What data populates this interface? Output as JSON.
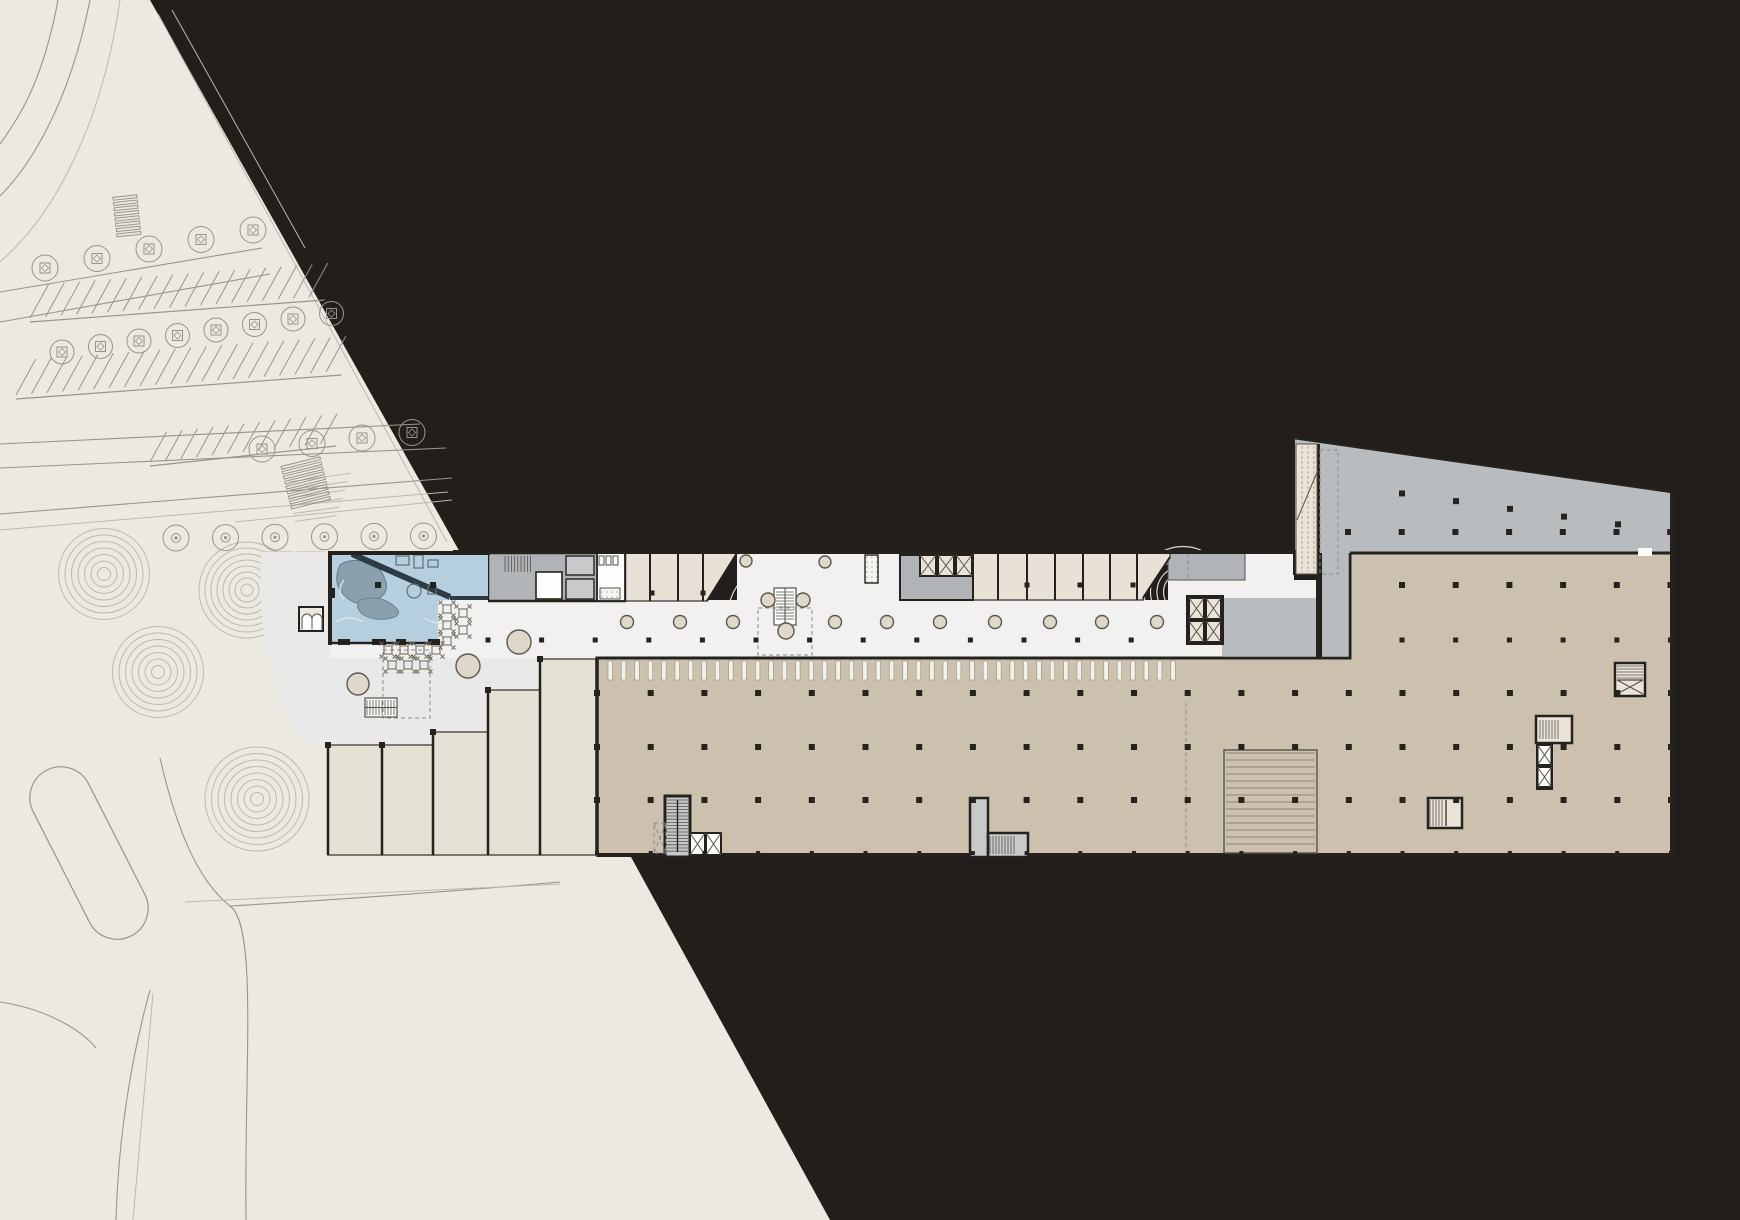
{
  "meta": {
    "drawing_kind": "architectural-site-and-floor-plan",
    "description": "Ground floor plan of an elongated mixed-use building with pool pavilion, mall concourse, retail units, parking floor, cores and landscaped site with roads and parking"
  },
  "palette": {
    "bg": "#211e1b",
    "site": "#ece9e1",
    "siteLine": "#99948b",
    "siteLineSoft": "#bcb8ae",
    "plaza": "#e9e9e8",
    "mall": "#f2f1ef",
    "ringPlaza": "#dbd9d4",
    "ringSite": "#beb9af",
    "tan": "#cbc1ae",
    "retail": "#e8e2d6",
    "terrace": "#e5e0d4",
    "grayZone": "#b9bcbe",
    "grayRoom": "#b1b4b7",
    "coreGray": "#c7c9cb",
    "wall": "#25221e",
    "wallSoft": "#56524b",
    "col": "#26231f",
    "pool": "#b6cfdf",
    "poolRock": "#8aa0ad",
    "poolRockDark": "#6e8493",
    "poolWall": "#2c3b44",
    "planter": "#ded7ca",
    "planterLine": "#5c5850",
    "white": "#fdfdfc",
    "cellCream": "#eae4d8"
  },
  "drawing": {
    "column_grids": [
      {
        "name": "mall-columns",
        "y": 640,
        "x0": 488,
        "dx": 53.6,
        "n": 13,
        "s": 5
      },
      {
        "name": "tan-row-1",
        "y": 693,
        "x0": 597,
        "dx": 53.7,
        "n": 21,
        "s": 6
      },
      {
        "name": "tan-row-2",
        "y": 747,
        "x0": 597,
        "dx": 53.7,
        "n": 21,
        "s": 6
      },
      {
        "name": "tan-row-3",
        "y": 800,
        "x0": 597,
        "dx": 53.7,
        "n": 21,
        "s": 6
      },
      {
        "name": "tan-row-4",
        "y": 853,
        "x0": 597,
        "dx": 53.7,
        "n": 21,
        "s": 4
      },
      {
        "name": "right-row-1",
        "y": 585,
        "x0": 1402,
        "dx": 53.7,
        "n": 6,
        "s": 6
      },
      {
        "name": "right-row-2",
        "y": 640,
        "x0": 1402,
        "dx": 53.7,
        "n": 6,
        "s": 5
      },
      {
        "name": "wing-row-2",
        "y": 532,
        "x0": 1348,
        "dx": 53.7,
        "n": 7,
        "s": 6
      },
      {
        "name": "retailA-cols",
        "y": 593,
        "x0": 652,
        "dx": 51,
        "n": 2,
        "s": 5
      },
      {
        "name": "retailB-cols",
        "y": 585,
        "x0": 1027,
        "dx": 53,
        "n": 3,
        "s": 5
      }
    ],
    "wing_slope_columns": {
      "x0": 1402,
      "dx": 54,
      "n": 5,
      "edge_y0": 438,
      "edge_x0": 1294,
      "slope": 0.143,
      "offset": 40,
      "s": 6
    },
    "corridor_circles": {
      "y": 622,
      "r": 6.5,
      "xs": [
        627,
        680,
        733,
        835,
        887,
        940,
        995,
        1050,
        1102,
        1157
      ]
    },
    "extra_circles": [
      [
        768,
        600,
        7
      ],
      [
        803,
        600,
        7
      ],
      [
        786,
        631,
        8
      ],
      [
        746,
        561,
        6
      ],
      [
        825,
        562,
        6
      ],
      [
        358,
        684,
        11
      ],
      [
        519,
        642,
        12
      ],
      [
        468,
        666,
        12
      ]
    ],
    "tick_band": {
      "x0": 608,
      "x1": 1172,
      "dx": 13.4,
      "y": 661,
      "h": 19,
      "w": 4.5
    },
    "ramp_lines": {
      "x": 1226,
      "w": 89,
      "y0": 753,
      "y1": 850,
      "dy": 7
    },
    "ring_sets": [
      {
        "cx": 104,
        "cy": 574,
        "n": 7,
        "dr": 6.5,
        "cls": "ring-site"
      },
      {
        "cx": 247,
        "cy": 590,
        "n": 8,
        "dr": 6,
        "cls": "ring-site"
      },
      {
        "cx": 158,
        "cy": 672,
        "n": 7,
        "dr": 6.5,
        "cls": "ring-site"
      },
      {
        "cx": 257,
        "cy": 799,
        "n": 8,
        "dr": 6.5,
        "cls": "ring-site"
      },
      {
        "cx": 375,
        "cy": 712,
        "n": 8,
        "dr": 6.5,
        "cls": "ring-plaza"
      },
      {
        "cx": 308,
        "cy": 648,
        "n": 6,
        "dr": 6.5,
        "cls": "ring-plaza"
      },
      {
        "cx": 612,
        "cy": 612,
        "n": 7,
        "dr": 6.5,
        "cls": "ring-plaza"
      },
      {
        "cx": 786,
        "cy": 618,
        "n": 9,
        "dr": 6.5,
        "cls": "ring-plaza"
      },
      {
        "cx": 945,
        "cy": 607,
        "n": 8,
        "dr": 7,
        "cls": "ring-plaza"
      },
      {
        "cx": 1183,
        "cy": 592,
        "n": 7,
        "dr": 6.5,
        "cls": "ring-plaza"
      },
      {
        "cx": 472,
        "cy": 628,
        "n": 4,
        "dr": 6,
        "cls": "ring-plaza"
      }
    ],
    "parking_rows": [
      {
        "x0": 30,
        "y0": 318,
        "dx": 15.5,
        "n": 19,
        "len": 34,
        "rise": 22
      },
      {
        "x0": 16,
        "y0": 395,
        "dx": 15.5,
        "n": 21,
        "len": 36,
        "rise": 24
      },
      {
        "x0": 150,
        "y0": 462,
        "dx": 15.5,
        "n": 12,
        "len": 30,
        "rise": 20
      }
    ],
    "tree_rows": [
      {
        "x0": 45,
        "y0": 268,
        "dx": 52,
        "dy": -9.5,
        "n": 5,
        "r": 13,
        "planter": true
      },
      {
        "x0": 62,
        "y0": 352,
        "dx": 38.5,
        "dy": -5.5,
        "n": 8,
        "r": 12,
        "planter": true
      },
      {
        "x0": 262,
        "y0": 449,
        "dx": 50,
        "dy": -5.5,
        "n": 4,
        "r": 13,
        "planter": true
      },
      {
        "x0": 176,
        "y0": 538,
        "dx": 49.5,
        "dy": -0.4,
        "n": 6,
        "r": 13,
        "planter": false
      }
    ],
    "crosswalks": [
      {
        "cx": 306,
        "cy": 484,
        "w": 40,
        "h": 46,
        "bars": 9,
        "rot": -14
      },
      {
        "cx": 127,
        "cy": 217,
        "w": 24,
        "h": 42,
        "bars": 8,
        "rot": -6
      }
    ],
    "tables": {
      "size": 8,
      "positions": [
        [
          447,
          609
        ],
        [
          447,
          625
        ],
        [
          447,
          641
        ],
        [
          463,
          613
        ],
        [
          463,
          630
        ],
        [
          388,
          650
        ],
        [
          404,
          650
        ],
        [
          420,
          650
        ],
        [
          436,
          650
        ],
        [
          392,
          665
        ],
        [
          408,
          665
        ],
        [
          424,
          665
        ]
      ]
    },
    "terraces": {
      "bottom": 855,
      "units": [
        {
          "x": 328,
          "w": 54,
          "top": 745
        },
        {
          "x": 382,
          "w": 51,
          "top": 745
        },
        {
          "x": 433,
          "w": 55,
          "top": 732
        },
        {
          "x": 488,
          "w": 52,
          "top": 690
        },
        {
          "x": 540,
          "w": 57,
          "top": 659
        }
      ]
    },
    "retail_a": {
      "x0": 625,
      "x1": 737,
      "y0": 553,
      "y1": 601,
      "dividers": [
        650,
        678,
        703
      ],
      "diag": [
        737,
        553,
        707,
        601
      ]
    },
    "retail_b": {
      "x0": 973,
      "x1": 1170,
      "y0": 553,
      "y1": 600,
      "dividers": [
        998,
        1027,
        1055,
        1083,
        1110,
        1137
      ],
      "diag": [
        1170,
        557,
        1143,
        598
      ]
    }
  }
}
